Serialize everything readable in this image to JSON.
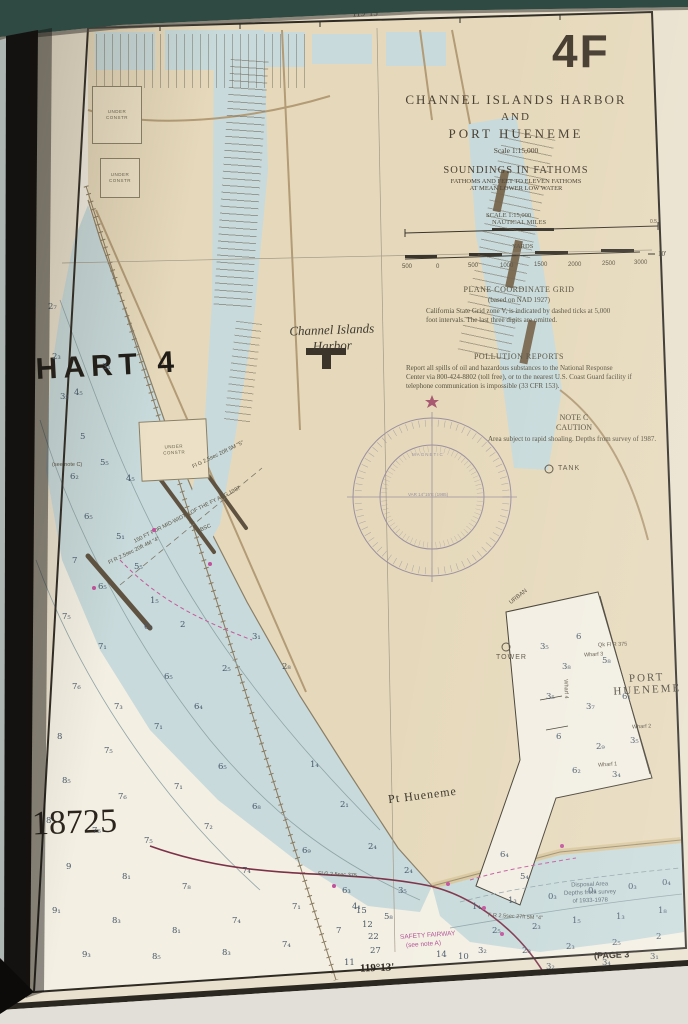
{
  "colors": {
    "land": "#e6d9bb",
    "shallow_water": "#c8dadb",
    "deep_water": "#f3efe3",
    "page": "#e9e1cd",
    "magenta": "#c2519c",
    "danger_line": "#7c3148",
    "book_cover": "#2e4a42"
  },
  "margin": {
    "corner_label": "4F",
    "chart_ref": "CHART 4",
    "chart_number": "18725",
    "top_longitude": "119°15'",
    "bottom_longitude": "119°13'",
    "right_latitude": "10'",
    "page_ref": "(PAGE 3"
  },
  "title_block": {
    "line1": "CHANNEL ISLANDS HARBOR",
    "line2": "AND",
    "line3": "PORT HUENEME",
    "scale": "Scale 1:15,000",
    "soundings_heading": "SOUNDINGS IN FATHOMS",
    "soundings_sub1": "FATHOMS AND FEET TO ELEVEN FATHOMS",
    "soundings_sub2": "AT MEAN LOWER LOW WATER",
    "scale_label": "SCALE 1:15,000",
    "miles_label": "NAUTICAL MILES",
    "yards_label": "YARDS"
  },
  "notes": {
    "plane_grid_title": "PLANE COORDINATE GRID",
    "plane_grid_sub": "(based on NAD 1927)",
    "plane_grid_body": "California State Grid zone V, is indicated by dashed ticks at 5,000 foot intervals. The last three digits are omitted.",
    "pollution_title": "POLLUTION REPORTS",
    "pollution_body": "Report all spills of oil and hazardous substances to the National Response Center via 800-424-8802 (toll free), or to the nearest U.S. Coast Guard facility if telephone communication is impossible (33 CFR 153).",
    "note_c_title": "NOTE C",
    "note_c_sub": "CAUTION",
    "note_c_body": "Area subject to rapid shoaling. Depths from survey of 1987.",
    "disposal_line1": "Disposal Area",
    "disposal_line2": "Depths from survey",
    "disposal_line3": "of 1933-1978"
  },
  "labels": {
    "harbor1": "Channel Islands",
    "harbor2": "Harbor",
    "port1": "PORT",
    "port2": "HUENEME",
    "pt_hueneme": "Pt Hueneme",
    "tank": "TANK",
    "tower": "TOWER",
    "magnetic": "MAGNETIC",
    "var_line": "VAR 14°15'E (1985)",
    "under_constr1": "UNDER",
    "under_constr2": "CONSTR",
    "safety1": "SAFETY FAIRWAY",
    "safety2": "(see note A)"
  },
  "yard_ticks": [
    {
      "x": 402,
      "y": 264,
      "t": "500"
    },
    {
      "x": 436,
      "y": 264,
      "t": "0"
    },
    {
      "x": 468,
      "y": 263,
      "t": "500"
    },
    {
      "x": 500,
      "y": 263,
      "t": "1000"
    },
    {
      "x": 534,
      "y": 262,
      "t": "1500"
    },
    {
      "x": 568,
      "y": 262,
      "t": "2000"
    },
    {
      "x": 602,
      "y": 261,
      "t": "2500"
    },
    {
      "x": 634,
      "y": 260,
      "t": "3000"
    }
  ],
  "tiny_labels": [
    {
      "x": 128,
      "y": 512,
      "rot": -27,
      "t": "150 FT FOR MID-WIDTH OF THE FY AUG 1987",
      "fs": 5.5
    },
    {
      "x": 190,
      "y": 452,
      "rot": -26,
      "t": "Fl G 2.5sec 20ft 5M \"5\"",
      "fs": 5.5
    },
    {
      "x": 106,
      "y": 548,
      "rot": -26,
      "t": "Fl R 2.5sec 20ft 4M \"4\"",
      "fs": 5.5
    },
    {
      "x": 196,
      "y": 526,
      "rot": -24,
      "t": "OBSC",
      "fs": 5.5
    },
    {
      "x": 318,
      "y": 872,
      "rot": 3,
      "t": "Fl G 2.5sec 375",
      "fs": 5.5
    },
    {
      "x": 488,
      "y": 914,
      "rot": 3,
      "t": "F R 2.5sec 27ft 5M \"4\"",
      "fs": 5.5
    },
    {
      "x": 598,
      "y": 642,
      "rot": -2,
      "t": "Qk Fl R 375",
      "fs": 5.5
    },
    {
      "x": 584,
      "y": 652,
      "rot": -3,
      "t": "Wharf 3",
      "fs": 5.5
    },
    {
      "x": 632,
      "y": 724,
      "rot": -3,
      "t": "Wharf 2",
      "fs": 5.5
    },
    {
      "x": 598,
      "y": 762,
      "rot": -4,
      "t": "Wharf 1",
      "fs": 5.5
    },
    {
      "x": 556,
      "y": 686,
      "rot": 88,
      "t": "Wharf 4",
      "fs": 5.5
    },
    {
      "x": 508,
      "y": 594,
      "rot": -38,
      "t": "URBAN",
      "fs": 6
    },
    {
      "x": 52,
      "y": 462,
      "rot": 0,
      "t": "(see note C)",
      "fs": 5.5
    },
    {
      "x": 650,
      "y": 219,
      "rot": 0,
      "t": "0.5",
      "fs": 5
    }
  ],
  "soundings_ocean": [
    {
      "x": 74,
      "y": 388,
      "t": "4₅"
    },
    {
      "x": 102,
      "y": 362,
      "t": "3₁"
    },
    {
      "x": 80,
      "y": 432,
      "t": "5"
    },
    {
      "x": 70,
      "y": 472,
      "t": "6₂"
    },
    {
      "x": 100,
      "y": 458,
      "t": "5₅"
    },
    {
      "x": 126,
      "y": 474,
      "t": "4₅"
    },
    {
      "x": 84,
      "y": 512,
      "t": "6₅"
    },
    {
      "x": 116,
      "y": 532,
      "t": "5₁"
    },
    {
      "x": 72,
      "y": 556,
      "t": "7"
    },
    {
      "x": 98,
      "y": 582,
      "t": "6₅"
    },
    {
      "x": 134,
      "y": 562,
      "t": "5₅"
    },
    {
      "x": 62,
      "y": 612,
      "t": "7₅"
    },
    {
      "x": 98,
      "y": 642,
      "t": "7₁"
    },
    {
      "x": 144,
      "y": 622,
      "t": "6₃"
    },
    {
      "x": 72,
      "y": 682,
      "t": "7₆"
    },
    {
      "x": 114,
      "y": 702,
      "t": "7₃"
    },
    {
      "x": 164,
      "y": 672,
      "t": "6₅"
    },
    {
      "x": 57,
      "y": 732,
      "t": "8"
    },
    {
      "x": 104,
      "y": 746,
      "t": "7₅"
    },
    {
      "x": 154,
      "y": 722,
      "t": "7₁"
    },
    {
      "x": 194,
      "y": 702,
      "t": "6₄"
    },
    {
      "x": 62,
      "y": 776,
      "t": "8₅"
    },
    {
      "x": 118,
      "y": 792,
      "t": "7₆"
    },
    {
      "x": 174,
      "y": 782,
      "t": "7₁"
    },
    {
      "x": 218,
      "y": 762,
      "t": "6₅"
    },
    {
      "x": 46,
      "y": 816,
      "t": "8"
    },
    {
      "x": 92,
      "y": 826,
      "t": "7₆"
    },
    {
      "x": 144,
      "y": 836,
      "t": "7₅"
    },
    {
      "x": 204,
      "y": 822,
      "t": "7₂"
    },
    {
      "x": 252,
      "y": 802,
      "t": "6₈"
    },
    {
      "x": 66,
      "y": 862,
      "t": "9"
    },
    {
      "x": 122,
      "y": 872,
      "t": "8₁"
    },
    {
      "x": 182,
      "y": 882,
      "t": "7₈"
    },
    {
      "x": 242,
      "y": 866,
      "t": "7₄"
    },
    {
      "x": 302,
      "y": 846,
      "t": "6₉"
    },
    {
      "x": 52,
      "y": 906,
      "t": "9₁"
    },
    {
      "x": 112,
      "y": 916,
      "t": "8₃"
    },
    {
      "x": 172,
      "y": 926,
      "t": "8₁"
    },
    {
      "x": 232,
      "y": 916,
      "t": "7₄"
    },
    {
      "x": 292,
      "y": 902,
      "t": "7₁"
    },
    {
      "x": 342,
      "y": 886,
      "t": "6₃"
    },
    {
      "x": 82,
      "y": 950,
      "t": "9₃"
    },
    {
      "x": 152,
      "y": 952,
      "t": "8₅"
    },
    {
      "x": 222,
      "y": 948,
      "t": "8₃"
    },
    {
      "x": 282,
      "y": 940,
      "t": "7₄"
    },
    {
      "x": 336,
      "y": 926,
      "t": "7"
    },
    {
      "x": 384,
      "y": 912,
      "t": "5₈"
    },
    {
      "x": 252,
      "y": 632,
      "t": "3₁"
    },
    {
      "x": 282,
      "y": 662,
      "t": "2₈"
    },
    {
      "x": 222,
      "y": 664,
      "t": "2₅"
    },
    {
      "x": 352,
      "y": 902,
      "t": "4₁"
    },
    {
      "x": 398,
      "y": 886,
      "t": "3₅"
    },
    {
      "x": 436,
      "y": 950,
      "t": "14"
    },
    {
      "x": 458,
      "y": 952,
      "t": "10"
    },
    {
      "x": 362,
      "y": 920,
      "t": "12"
    },
    {
      "x": 368,
      "y": 932,
      "t": "22"
    },
    {
      "x": 370,
      "y": 946,
      "t": "27"
    },
    {
      "x": 344,
      "y": 958,
      "t": "11"
    },
    {
      "x": 356,
      "y": 906,
      "t": "15"
    }
  ],
  "soundings_harbor": [
    {
      "x": 540,
      "y": 642,
      "t": "3₅"
    },
    {
      "x": 576,
      "y": 632,
      "t": "6"
    },
    {
      "x": 562,
      "y": 662,
      "t": "3₈"
    },
    {
      "x": 602,
      "y": 656,
      "t": "5₈"
    },
    {
      "x": 546,
      "y": 692,
      "t": "3₅"
    },
    {
      "x": 586,
      "y": 702,
      "t": "3₇"
    },
    {
      "x": 622,
      "y": 692,
      "t": "6₁"
    },
    {
      "x": 556,
      "y": 732,
      "t": "6"
    },
    {
      "x": 596,
      "y": 742,
      "t": "2₉"
    },
    {
      "x": 630,
      "y": 736,
      "t": "3₅"
    },
    {
      "x": 572,
      "y": 766,
      "t": "6₂"
    },
    {
      "x": 612,
      "y": 770,
      "t": "3₄"
    },
    {
      "x": 500,
      "y": 850,
      "t": "6₄"
    },
    {
      "x": 520,
      "y": 872,
      "t": "5₄"
    }
  ],
  "soundings_shallow": [
    {
      "x": 472,
      "y": 902,
      "t": "1₄"
    },
    {
      "x": 508,
      "y": 896,
      "t": "1₃"
    },
    {
      "x": 548,
      "y": 892,
      "t": "0₃"
    },
    {
      "x": 588,
      "y": 886,
      "t": "0₁"
    },
    {
      "x": 628,
      "y": 882,
      "t": "0₃"
    },
    {
      "x": 662,
      "y": 878,
      "t": "0₄"
    },
    {
      "x": 492,
      "y": 926,
      "t": "2₅"
    },
    {
      "x": 532,
      "y": 922,
      "t": "2₃"
    },
    {
      "x": 572,
      "y": 916,
      "t": "1₅"
    },
    {
      "x": 616,
      "y": 912,
      "t": "1₃"
    },
    {
      "x": 658,
      "y": 906,
      "t": "1₈"
    },
    {
      "x": 478,
      "y": 946,
      "t": "3₂"
    },
    {
      "x": 522,
      "y": 946,
      "t": "2₈"
    },
    {
      "x": 566,
      "y": 942,
      "t": "2₃"
    },
    {
      "x": 612,
      "y": 938,
      "t": "2₅"
    },
    {
      "x": 656,
      "y": 932,
      "t": "2"
    },
    {
      "x": 546,
      "y": 962,
      "t": "3₂"
    },
    {
      "x": 602,
      "y": 958,
      "t": "3₄"
    },
    {
      "x": 650,
      "y": 952,
      "t": "3₁"
    },
    {
      "x": 52,
      "y": 352,
      "t": "2₃"
    },
    {
      "x": 60,
      "y": 392,
      "t": "3₅"
    },
    {
      "x": 48,
      "y": 302,
      "t": "2₇"
    },
    {
      "x": 150,
      "y": 596,
      "t": "1₅"
    },
    {
      "x": 180,
      "y": 620,
      "t": "2"
    },
    {
      "x": 310,
      "y": 760,
      "t": "1₄"
    },
    {
      "x": 340,
      "y": 800,
      "t": "2₁"
    },
    {
      "x": 368,
      "y": 842,
      "t": "2₄"
    },
    {
      "x": 404,
      "y": 866,
      "t": "2₄"
    }
  ],
  "flares": [
    {
      "x": 152,
      "y": 528
    },
    {
      "x": 208,
      "y": 562
    },
    {
      "x": 92,
      "y": 586
    },
    {
      "x": 332,
      "y": 884
    },
    {
      "x": 446,
      "y": 882
    },
    {
      "x": 482,
      "y": 906
    },
    {
      "x": 500,
      "y": 932
    },
    {
      "x": 560,
      "y": 844
    }
  ]
}
